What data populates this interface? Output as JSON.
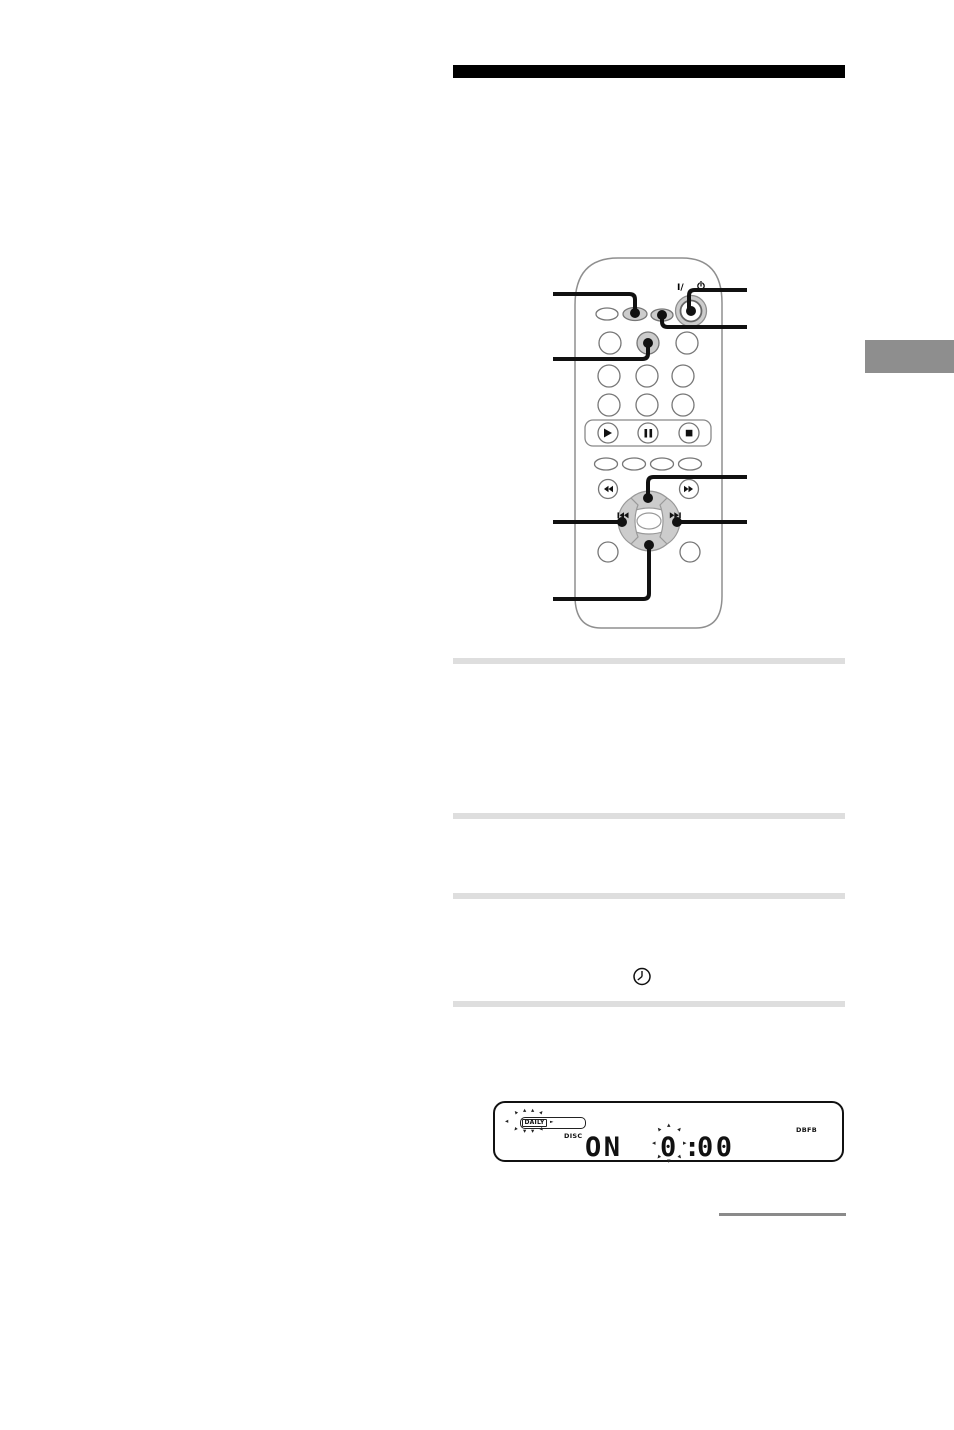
{
  "page": {
    "background": "#ffffff",
    "top_bar_color": "#000000",
    "side_tab_color": "#8e8e8e",
    "divider_color": "#dedede",
    "rule_color": "#8a8a8a"
  },
  "remote": {
    "power_label": "I/",
    "body_outline_color": "#8f8f8f",
    "button_outline_color": "#777777",
    "button_gray": "#cccccc",
    "callout_color": "#111111",
    "icons": {
      "power": "power-icon",
      "play": "▶",
      "pause": "❚❚",
      "stop": "■",
      "rewind": "◀◀",
      "fast_forward": "▶▶",
      "previous": "❙◀◀",
      "next": "▶▶❙",
      "dpad": "direction-pad"
    }
  },
  "timer": {
    "clock_icon": "clock"
  },
  "display": {
    "daily": "DAILY",
    "daily_arrow": "►",
    "disc": "DISC",
    "on": "ON",
    "hour": "0",
    "colon": ":",
    "minutes": "00",
    "dbfb": "DBFB",
    "ray_up": "▴",
    "ray_down": "▾",
    "ray_left": "◂",
    "ray_right": "▸"
  }
}
